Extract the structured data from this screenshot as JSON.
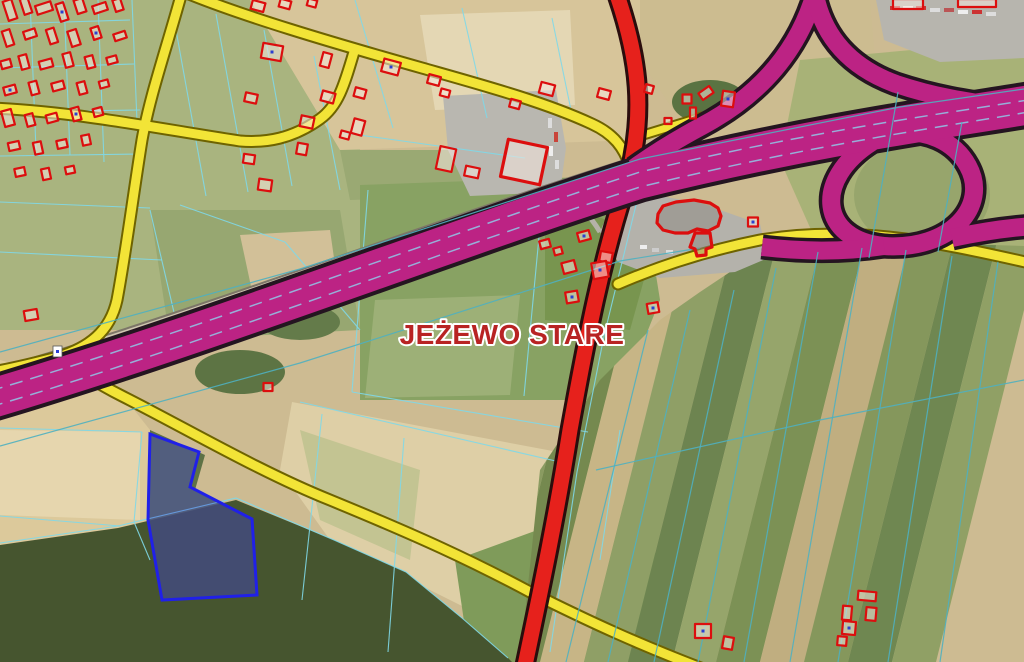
{
  "canvas": {
    "width": 1024,
    "height": 662
  },
  "colors": {
    "motorway": "#bc2384",
    "motorway_casing": "#241520",
    "primary_road": "#e6211c",
    "primary_casing": "#2a0d0d",
    "secondary_road": "#f2e437",
    "secondary_casing": "#6e6300",
    "parcel_line_bright": "#7fd8e8",
    "parcel_line_field": "#4fb0c0",
    "lane_dash": "#90c8e8",
    "building_outline": "#dc0e0e",
    "selected_parcel": "#2020e8",
    "label_color": "#b82323"
  },
  "overlay": {
    "label": {
      "text": "JEŻEWO STARE",
      "x": 512,
      "y": 344,
      "size": 28,
      "fill": "#b82323",
      "halo": "#ffffff"
    },
    "marker": {
      "x": 53,
      "y": 346,
      "w": 9,
      "h": 11,
      "dot": "#2a3fd4"
    },
    "parcels": {
      "color_bright": "#7fd8e8",
      "color_field": "#4fb0c0",
      "under": [
        "30,0 36,150",
        "64,0 70,155",
        "98,0 104,162",
        "132,0 139,170",
        "0,24 130,20",
        "0,68 134,64",
        "0,112 140,110",
        "0,156 144,154",
        "0,202 150,208",
        "0,252 162,260",
        "172,8 206,196",
        "216,14 248,192",
        "264,30 292,186",
        "314,56 340,190",
        "150,210 180,338",
        "180,205 285,242",
        "285,242 360,330",
        "355,0 393,128",
        "462,8 487,118",
        "552,18 572,115",
        "345,133 525,158",
        "368,190 352,392",
        "352,392 588,432",
        "542,205 524,396",
        "322,414 302,600",
        "404,438 388,652",
        "300,402 560,462",
        "0,428 142,432",
        "0,516 120,526",
        "0,543 118,526 236,498 334,540 406,572 462,618 508,658",
        "142,432 134,522 150,560",
        "636,205 604,336 577,472 550,652",
        "620,430 600,560"
      ],
      "over": [
        "0,352 300,269 640,159 900,107 1024,89",
        "0,446 300,363 620,261 700,248",
        "648,330 566,662",
        "690,310 608,662",
        "734,290 654,662",
        "776,268 698,662",
        "818,252 744,662",
        "862,248 790,662",
        "906,250 838,662",
        "952,256 888,662",
        "998,262 940,662",
        "596,470 820,420 1024,380",
        "898,92 869,258",
        "962,122 938,252"
      ],
      "selected": {
        "points": "150,434 199,452 190,487 252,519 257,595 162,600 148,520",
        "stroke": "#2020e8",
        "fill": "rgba(64,64,220,0.38)"
      }
    },
    "roads": {
      "frontage": {
        "d": "M -10,374 C 200,314 420,228 630,162",
        "casing": "#7c7668",
        "cw": 9,
        "fill": "#cfc6b0",
        "w": 5
      },
      "secondary_colors": {
        "fill": "#f2e437",
        "casing": "#6e6300"
      },
      "secondary": [
        {
          "d": "M 182,-8 C 166,50 150,95 142,140 C 133,196 126,252 117,300 C 110,332 88,348 58,357 C 35,363 15,368 -8,372",
          "w": 9,
          "cw": 13
        },
        {
          "d": "M 66,360 C 80,372 100,385 122,396 C 180,425 260,472 330,500 C 420,537 470,560 530,592 C 590,622 640,645 706,670",
          "w": 9,
          "cw": 13
        },
        {
          "d": "M 184,-8 C 242,16 330,42 422,68 C 482,85 545,102 592,124 C 614,134 624,148 630,166",
          "w": 9,
          "cw": 13
        },
        {
          "d": "M 354,52 C 344,86 338,106 320,119 C 292,139 266,143 240,141 C 160,129 80,112 -8,108",
          "w": 9,
          "cw": 13
        },
        {
          "d": "M 618,284 C 655,268 700,252 760,240 C 830,228 900,236 960,248 C 985,253 1008,258 1034,264",
          "w": 9,
          "cw": 13
        },
        {
          "d": "M 640,136 L 702,117",
          "w": 7,
          "cw": 11
        }
      ],
      "primary": {
        "d": "M 616,-8 C 638,55 648,115 624,192 C 602,262 588,330 570,430 C 557,512 543,580 524,670",
        "fill": "#e6211c",
        "casing": "#2a0d0d",
        "w": 15,
        "cw": 21
      },
      "motorway": {
        "fill": "#bc2384",
        "casing": "#241520",
        "paths": [
          {
            "d": "M 816,-10 C 800,48 762,94 702,126 C 672,142 652,155 634,168",
            "w": 18,
            "cw": 25
          },
          {
            "d": "M 814,-10 C 822,38 852,68 896,84 C 935,97 968,102 1000,106",
            "w": 18,
            "cw": 25
          },
          {
            "d": "M 872,142 C 812,180 820,240 884,246 C 950,251 990,206 968,166 C 954,140 925,130 898,132",
            "w": 18,
            "cw": 25
          },
          {
            "d": "M 952,238 C 980,232 1005,228 1034,226",
            "w": 18,
            "cw": 25
          },
          {
            "d": "M 884,246 C 845,252 805,252 762,247",
            "w": 18,
            "cw": 25
          },
          {
            "d": "M -10,399 C 200,337 430,247 640,179 C 820,135 950,118 1034,104",
            "w": 39,
            "cw": 47
          }
        ],
        "lane_dashes": [
          "M -10,391 C 200,329 430,240 640,172 C 820,129 950,113 1034,99",
          "M -10,407 C 200,345 430,255 640,187 C 820,143 950,126 1034,111"
        ]
      }
    },
    "buildings": {
      "stroke": "#dc0e0e",
      "fill": "rgba(245,232,222,0.55)",
      "complex_fill": "rgba(140,135,130,0.5)",
      "dot_color": "#2b3fd0",
      "rects": [
        [
          10,
          10,
          9,
          20,
          -18,
          0
        ],
        [
          26,
          6,
          8,
          16,
          -18,
          0
        ],
        [
          44,
          8,
          16,
          9,
          -18,
          0
        ],
        [
          62,
          12,
          8,
          18,
          -18,
          1
        ],
        [
          80,
          6,
          9,
          14,
          -18,
          0
        ],
        [
          100,
          8,
          14,
          8,
          -18,
          0
        ],
        [
          118,
          5,
          8,
          12,
          -18,
          0
        ],
        [
          8,
          38,
          8,
          16,
          -18,
          0
        ],
        [
          30,
          34,
          12,
          8,
          -18,
          0
        ],
        [
          52,
          36,
          8,
          15,
          -18,
          0
        ],
        [
          74,
          38,
          9,
          16,
          -18,
          0
        ],
        [
          96,
          33,
          8,
          12,
          -18,
          1
        ],
        [
          120,
          36,
          12,
          7,
          -18,
          0
        ],
        [
          6,
          64,
          10,
          8,
          -15,
          0
        ],
        [
          24,
          62,
          8,
          14,
          -15,
          0
        ],
        [
          46,
          64,
          13,
          8,
          -15,
          0
        ],
        [
          68,
          60,
          8,
          14,
          -15,
          0
        ],
        [
          90,
          62,
          8,
          12,
          -15,
          0
        ],
        [
          112,
          60,
          10,
          7,
          -15,
          0
        ],
        [
          10,
          90,
          12,
          8,
          -15,
          1
        ],
        [
          34,
          88,
          8,
          13,
          -15,
          0
        ],
        [
          58,
          86,
          12,
          8,
          -15,
          0
        ],
        [
          82,
          88,
          8,
          12,
          -15,
          0
        ],
        [
          104,
          84,
          9,
          7,
          -15,
          0
        ],
        [
          8,
          118,
          10,
          16,
          -15,
          0
        ],
        [
          30,
          120,
          8,
          12,
          -15,
          0
        ],
        [
          52,
          118,
          11,
          8,
          -15,
          0
        ],
        [
          76,
          114,
          8,
          13,
          -15,
          1
        ],
        [
          98,
          112,
          9,
          8,
          -15,
          0
        ],
        [
          14,
          146,
          11,
          8,
          -12,
          0
        ],
        [
          38,
          148,
          8,
          12,
          -12,
          0
        ],
        [
          62,
          144,
          10,
          8,
          -12,
          0
        ],
        [
          86,
          140,
          8,
          10,
          -12,
          0
        ],
        [
          20,
          172,
          10,
          8,
          -12,
          0
        ],
        [
          46,
          174,
          8,
          11,
          -12,
          0
        ],
        [
          70,
          170,
          9,
          7,
          -12,
          0
        ],
        [
          31,
          315,
          13,
          10,
          -10,
          0
        ],
        [
          258,
          6,
          13,
          9,
          15,
          0
        ],
        [
          285,
          4,
          11,
          8,
          15,
          0
        ],
        [
          312,
          3,
          9,
          7,
          15,
          0
        ],
        [
          272,
          52,
          20,
          15,
          10,
          1
        ],
        [
          326,
          60,
          9,
          14,
          15,
          0
        ],
        [
          391,
          67,
          17,
          13,
          15,
          1
        ],
        [
          434,
          80,
          12,
          9,
          15,
          0
        ],
        [
          445,
          93,
          9,
          7,
          15,
          0
        ],
        [
          251,
          98,
          12,
          9,
          12,
          0
        ],
        [
          328,
          97,
          13,
          10,
          15,
          0
        ],
        [
          360,
          93,
          11,
          9,
          15,
          0
        ],
        [
          307,
          122,
          13,
          11,
          12,
          0
        ],
        [
          358,
          127,
          11,
          15,
          15,
          0
        ],
        [
          345,
          135,
          9,
          7,
          15,
          0
        ],
        [
          302,
          149,
          10,
          11,
          10,
          0
        ],
        [
          249,
          159,
          11,
          9,
          8,
          0
        ],
        [
          265,
          185,
          13,
          11,
          8,
          0
        ],
        [
          547,
          89,
          14,
          11,
          15,
          0
        ],
        [
          604,
          94,
          12,
          9,
          15,
          0
        ],
        [
          649,
          89,
          8,
          8,
          15,
          0
        ],
        [
          515,
          104,
          10,
          8,
          15,
          0
        ],
        [
          524,
          162,
          40,
          38,
          12,
          0,
          3.2
        ],
        [
          446,
          159,
          16,
          23,
          12,
          0
        ],
        [
          472,
          172,
          14,
          10,
          12,
          0
        ],
        [
          706,
          93,
          13,
          8,
          -35,
          0
        ],
        [
          687,
          99,
          9,
          9,
          0,
          0
        ],
        [
          728,
          99,
          12,
          15,
          8,
          1
        ],
        [
          693,
          113,
          6,
          11,
          0,
          0
        ],
        [
          668,
          121,
          7,
          6,
          0,
          0
        ],
        [
          908,
          4,
          30,
          10,
          0,
          0
        ],
        [
          977,
          3,
          38,
          8,
          0,
          0
        ],
        [
          753,
          222,
          10,
          9,
          0,
          1
        ],
        [
          606,
          257,
          12,
          10,
          10,
          0
        ],
        [
          584,
          236,
          12,
          9,
          -15,
          1
        ],
        [
          545,
          244,
          10,
          8,
          -15,
          0
        ],
        [
          558,
          251,
          8,
          7,
          -15,
          0
        ],
        [
          569,
          267,
          13,
          11,
          -15,
          0
        ],
        [
          600,
          270,
          15,
          16,
          -10,
          1
        ],
        [
          572,
          297,
          12,
          11,
          -10,
          1
        ],
        [
          653,
          308,
          11,
          10,
          -10,
          1
        ],
        [
          268,
          387,
          9,
          8,
          0,
          0
        ],
        [
          867,
          596,
          18,
          9,
          5,
          0
        ],
        [
          847,
          613,
          9,
          14,
          5,
          0
        ],
        [
          871,
          614,
          10,
          13,
          5,
          0
        ],
        [
          849,
          628,
          13,
          13,
          5,
          1
        ],
        [
          842,
          641,
          9,
          9,
          5,
          0
        ],
        [
          703,
          631,
          16,
          14,
          0,
          1
        ],
        [
          728,
          643,
          10,
          12,
          10,
          0
        ]
      ],
      "polygons": [
        {
          "pts": "658,214 663,206 676,202 694,200 710,203 718,208 721,216 718,226 708,231 697,229 688,233 675,233 663,230 657,223"
        },
        {
          "pts": "695,233 710,233 712,247 706,249 706,255 697,256 695,249 690,247"
        }
      ]
    }
  }
}
